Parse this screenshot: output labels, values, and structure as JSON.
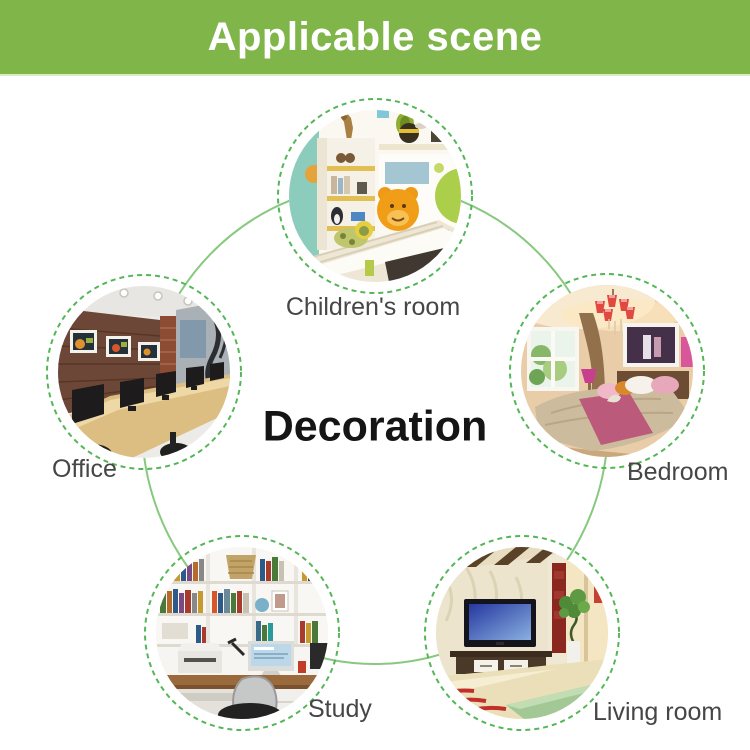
{
  "header": {
    "title": "Applicable scene",
    "background_color": "#80b549",
    "text_color": "#ffffff"
  },
  "diagram": {
    "center_label": "Decoration",
    "connector_color": "#87c97e",
    "dashed_ring_color": "#54b657",
    "label_color": "#464646",
    "scenes": [
      {
        "id": "childrens-room",
        "label": "Children's room"
      },
      {
        "id": "office",
        "label": "Office"
      },
      {
        "id": "bedroom",
        "label": "Bedroom"
      },
      {
        "id": "study",
        "label": "Study"
      },
      {
        "id": "living-room",
        "label": "Living room"
      }
    ]
  }
}
